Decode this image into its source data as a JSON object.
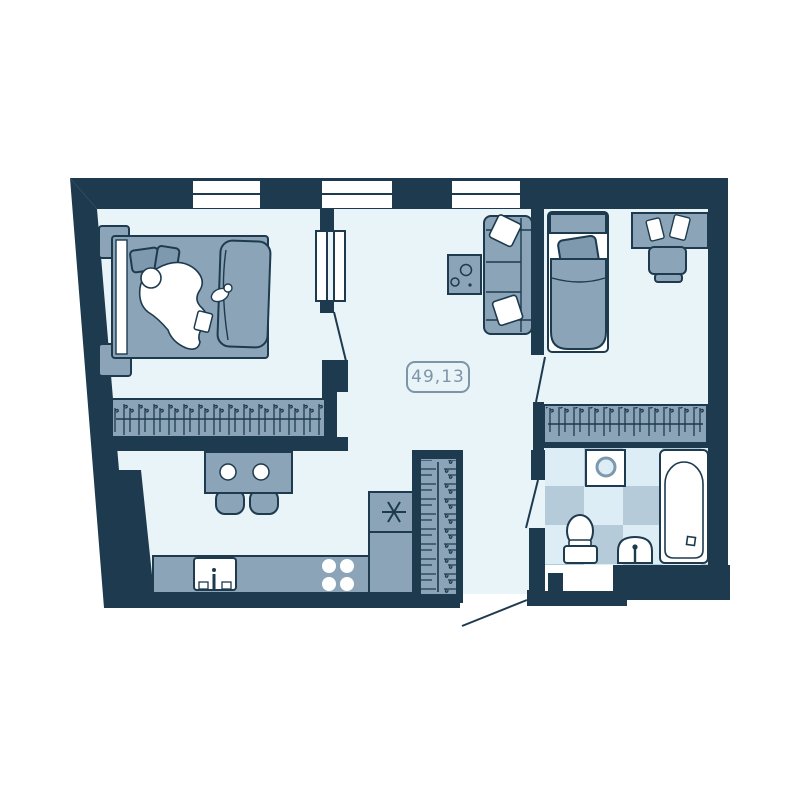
{
  "floor_plan": {
    "area_label": "49,13",
    "colors": {
      "background": "#ffffff",
      "wall": "#1d3a4e",
      "floor": "#e9f4f9",
      "furniture": "#8ba4b7",
      "furniture_dark": "#7e99ad",
      "tile_light": "#dcedf5",
      "tile_mid": "#b5cbda",
      "white": "#ffffff",
      "label": "#7e95a8"
    },
    "windows": {
      "count": 3,
      "location": "top-exterior-wall"
    },
    "rooms": [
      {
        "name": "bedroom-main",
        "furniture": [
          "double-bed",
          "pillows",
          "duvet",
          "sleeping-person-illustration",
          "cat-illustration",
          "nightstand-top",
          "nightstand-bottom",
          "wardrobe-hanger-rail"
        ]
      },
      {
        "name": "living-kitchen",
        "furniture": [
          "double-door-panels",
          "sofa",
          "sofa-pillows",
          "coffee-table",
          "bar-table",
          "bar-stool",
          "bar-stool",
          "kitchen-counter",
          "kitchen-sink",
          "stove-4-burners",
          "fridge-snowflake-symbol",
          "hallway-coat-closet"
        ]
      },
      {
        "name": "bedroom-second",
        "furniture": [
          "single-bed",
          "pillow",
          "desk",
          "desk-papers",
          "desk-chair",
          "wardrobe-hanger-rail"
        ]
      },
      {
        "name": "bathroom",
        "floor": "checkered-tiles",
        "furniture": [
          "washing-machine",
          "toilet",
          "wash-basin",
          "bathtub"
        ]
      }
    ],
    "doors": [
      "bedroom-main-double-door",
      "bedroom-second-door",
      "bathroom-door",
      "entrance-door"
    ]
  }
}
